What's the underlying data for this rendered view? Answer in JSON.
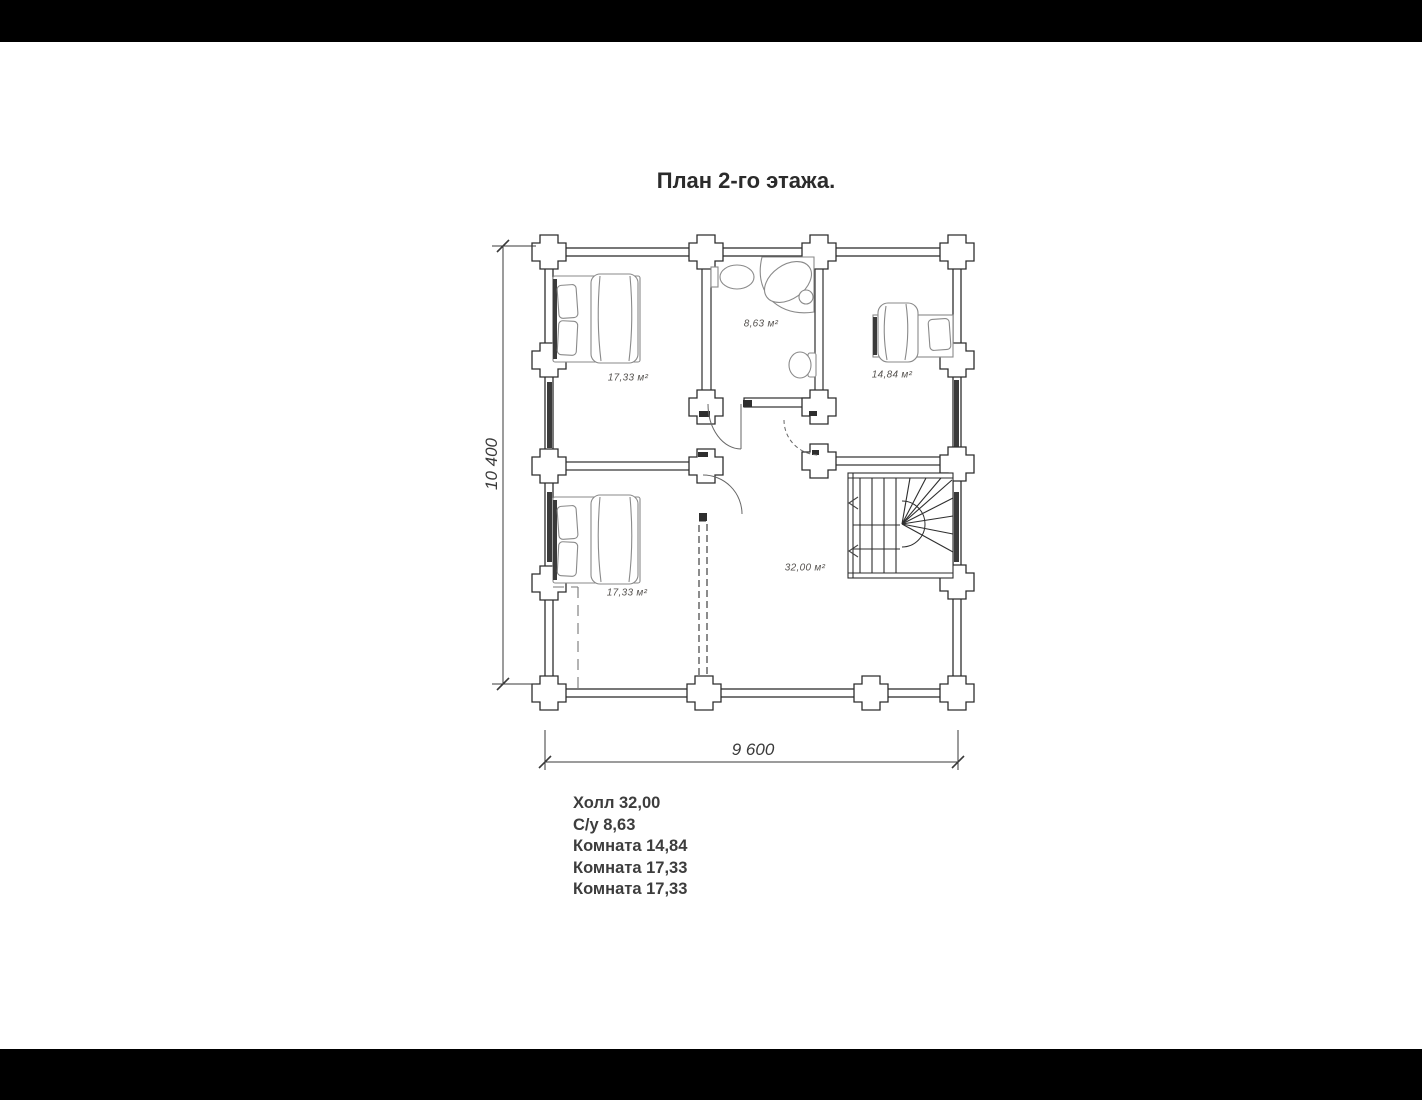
{
  "title": {
    "text": "План 2-го этажа."
  },
  "rooms": [
    {
      "name": "bedroom-upper-left",
      "area_label": "17,33 м²"
    },
    {
      "name": "bathroom",
      "area_label": "8,63 м²"
    },
    {
      "name": "bedroom-right",
      "area_label": "14,84 м²"
    },
    {
      "name": "bedroom-lower-left",
      "area_label": "17,33 м²"
    },
    {
      "name": "hall",
      "area_label": "32,00 м²"
    }
  ],
  "dimensions": {
    "horizontal": "9 600",
    "vertical": "10 400"
  },
  "legend": {
    "items": [
      "Холл 32,00",
      "С/у 8,63",
      "Комната 14,84",
      "Комната 17,33",
      "Комната 17,33"
    ]
  },
  "colors": {
    "letterbox": "#000000",
    "wall_ink": "#2e2e2e",
    "sketch_ink": "#8a8a8a",
    "label_ink": "#55524f",
    "text_ink": "#3d3d3d",
    "background": "#ffffff"
  }
}
